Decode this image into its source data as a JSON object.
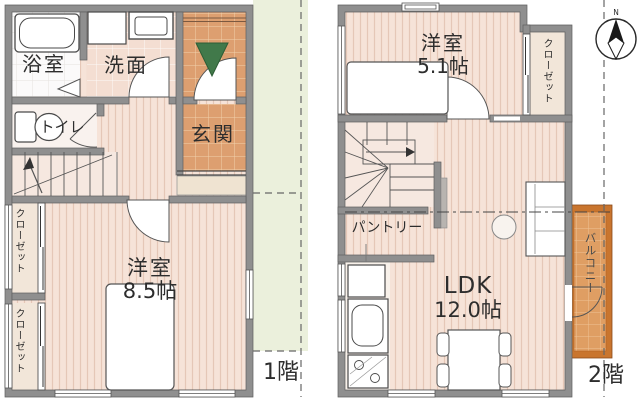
{
  "floor1": {
    "label": "1階",
    "rooms": {
      "bathroom": "浴室",
      "washroom": "洗面",
      "toilet": "トイレ",
      "entrance": "玄関",
      "bedroom": {
        "name": "洋室",
        "size": "8.5帖"
      },
      "closet_upper": "クローゼット",
      "closet_lower": "クローゼット"
    }
  },
  "floor2": {
    "label": "2階",
    "rooms": {
      "bedroom": {
        "name": "洋室",
        "size": "5.1帖"
      },
      "closet": "クローゼット",
      "pantry": "パントリー",
      "ldk": {
        "name": "LDK",
        "size": "12.0帖"
      },
      "balcony": "バルコニー"
    }
  },
  "compass": {
    "north": "N"
  },
  "colors": {
    "wall": "#8f8f8f",
    "wood_floor": "#f6e3d8",
    "entrance_tile": "#dd9f70",
    "balcony_frame": "#c9752e",
    "garden_area": "#ebf0dc",
    "entry_arrow": "#41794a"
  }
}
